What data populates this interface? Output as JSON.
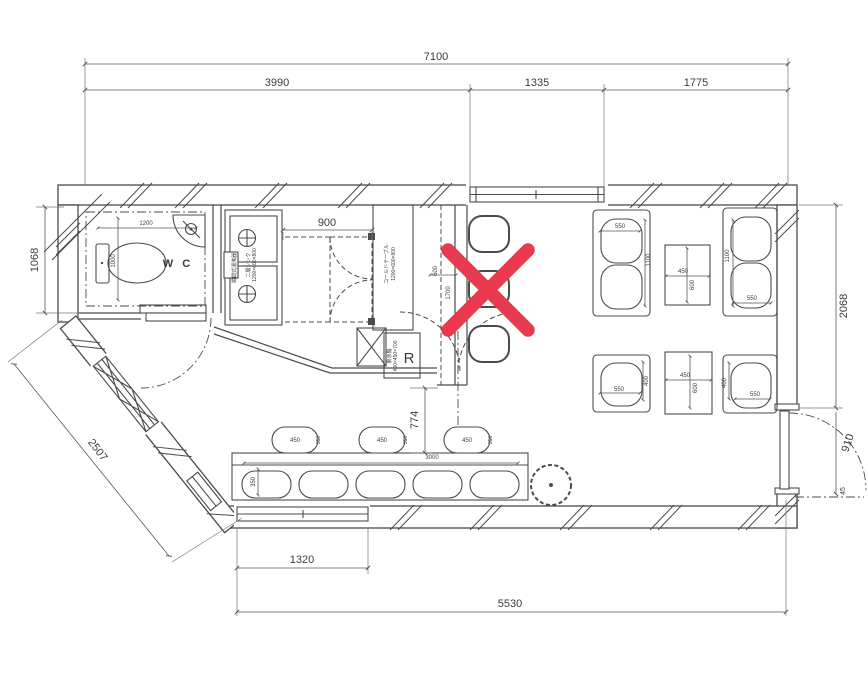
{
  "drawing": {
    "type": "restaurant-floor-plan",
    "rooms": {
      "wc": "W C"
    },
    "equipment": {
      "water_heater": "瞬間式湯沸器",
      "sink_name": "二層シンク",
      "sink_size": "1200×600×800",
      "cold_table_name": "コールドテーブル",
      "cold_table_size": "1200×600×800",
      "ice_maker_name": "製氷機",
      "ice_maker_size": "400×450×700",
      "refrigerator": "R"
    },
    "dims": {
      "overall_top": "7100",
      "seg_left": "3990",
      "seg_mid": "1335",
      "seg_right": "1775",
      "left_height": "1068",
      "right_height": "2068",
      "diagonal_wall": "2507",
      "bottom_window": "1320",
      "bottom_overall": "5530",
      "kitchen_opening": "900",
      "counter_clearance": "774",
      "entry_door": "910",
      "entry_gap": "45"
    },
    "fixture_dims": {
      "wc_w": "1200",
      "wc_d": "1000",
      "counter_w": "600",
      "counter_l": "1700",
      "cushion": "550",
      "bench_l": "1100",
      "bench_d": "400",
      "table_w": "450",
      "table_l": "600",
      "bench_bottom_l": "3000",
      "bench_bottom_d": "350",
      "stool_w": "450",
      "stool_d": "350"
    },
    "colors": {
      "line": "#4b4b4b",
      "red_x": "#e8394e",
      "background": "#ffffff"
    },
    "annotation": {
      "type": "red-x-mark"
    }
  }
}
